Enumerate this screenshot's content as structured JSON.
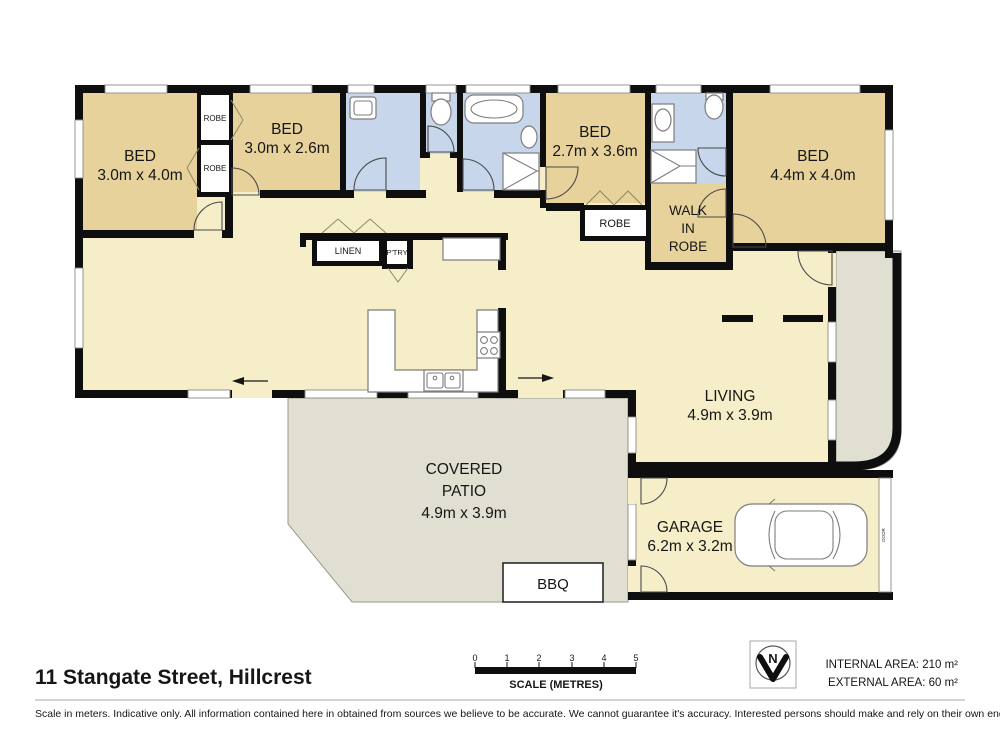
{
  "title": "11 Stangate Street, Hillcrest",
  "rooms": {
    "bed1": {
      "name": "BED",
      "dims": "3.0m x 4.0m"
    },
    "bed2": {
      "name": "BED",
      "dims": "3.0m x 2.6m"
    },
    "bed3": {
      "name": "BED",
      "dims": "2.7m x 3.6m"
    },
    "bed4": {
      "name": "BED",
      "dims": "4.4m x 4.0m"
    },
    "living": {
      "name": "LIVING",
      "dims": "4.9m x 3.9m"
    },
    "garage": {
      "name": "GARAGE",
      "dims": "6.2m x 3.2m"
    },
    "patio": {
      "line1": "COVERED",
      "line2": "PATIO",
      "dims": "4.9m x 3.9m"
    },
    "wir": {
      "line1": "WALK",
      "line2": "IN",
      "line3": "ROBE"
    },
    "robe_bed2": "ROBE",
    "robe_bed1": "ROBE",
    "robe_bed3": "ROBE",
    "linen": "LINEN",
    "pantry": "P'TRY",
    "bbq": "BBQ",
    "garage_door": "DOOR"
  },
  "scale_bar": {
    "ticks": [
      "0",
      "1",
      "2",
      "3",
      "4",
      "5"
    ],
    "label": "SCALE (METRES)"
  },
  "north_label": "N",
  "areas": {
    "internal": "INTERNAL AREA: 210 m²",
    "external": "EXTERNAL AREA: 60 m²"
  },
  "disclaimer": "Scale in meters. Indicative only. All information contained here in obtained from sources we believe to be accurate. We cannot guarantee it's accuracy. Interested persons should make and rely on their own enquiries",
  "colors": {
    "room_tan": "#e7d29b",
    "floor_cream": "#f6eec9",
    "wet_area_blue": "#c7d6eb",
    "outdoor_grey": "#e0dfd1",
    "wall": "#0e0e0e"
  }
}
